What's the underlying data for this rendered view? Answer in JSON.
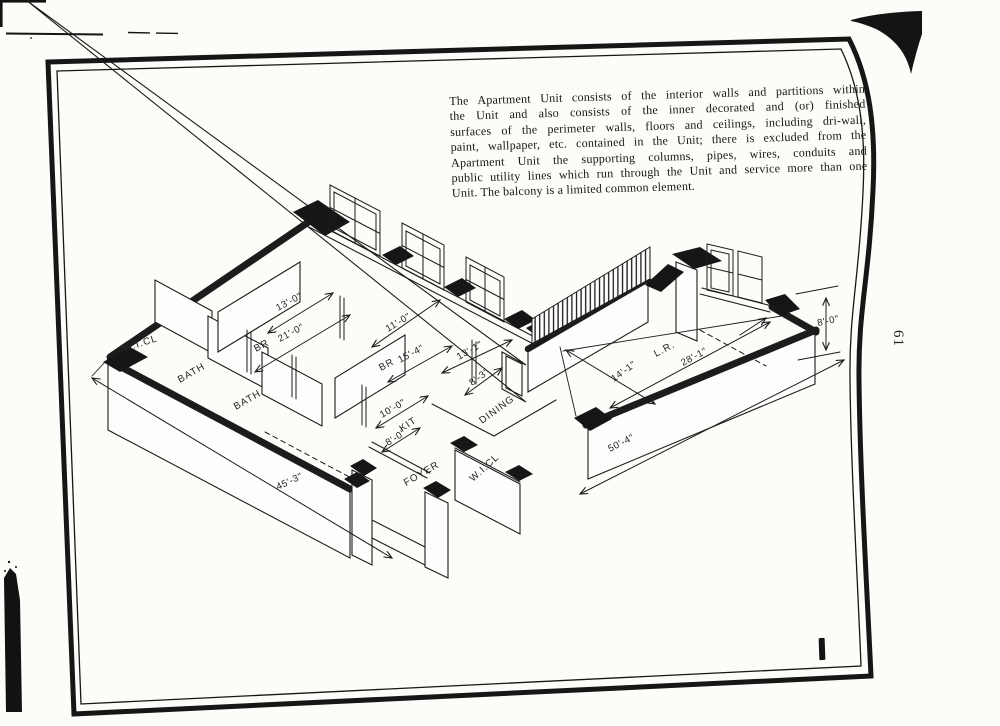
{
  "paragraph": {
    "lines": [
      "The Apartment Unit consists of the interior walls and partitions within",
      "the Unit and also consists of the inner decorated and (or) finished",
      "surfaces of the perimeter walls, floors and ceilings, including dri-wall,",
      "paint, wallpaper, etc. contained in the Unit; there is excluded from the",
      "Apartment Unit the supporting columns, pipes, wires, conduits and",
      "public utility lines which run through the Unit and service more than one",
      "Unit. The balcony is a limited common element."
    ]
  },
  "page": {
    "number": "61",
    "figure_mark": "1"
  },
  "labels": {
    "wicl1": "W.I.CL",
    "bath1": "BATH",
    "bath2": "BATH",
    "br1": "BR",
    "br2": "BR",
    "kit": "KIT",
    "dining": "DINING",
    "foyer": "FOYER",
    "wicl2": "W.I.CL",
    "lr": "L.R."
  },
  "dimensions": {
    "br1_len": "21'-0\"",
    "br1_wid": "13'-0\"",
    "br2_wid": "11'-0\"",
    "br2_len": "15'-4\"",
    "dining_len": "13'-1\"",
    "dining_wid": "8'-3\"",
    "kit_len": "10'-0\"",
    "kit_wid": "8'-0\"",
    "lr_wid": "14'-1\"",
    "lr_len": "28'-1\"",
    "wall_height": "8'-0\"",
    "right_total": "50'-4\"",
    "left_total": "45'-3\""
  },
  "colors": {
    "ink": "#1c1c1c",
    "paper": "#fcfcf9"
  }
}
